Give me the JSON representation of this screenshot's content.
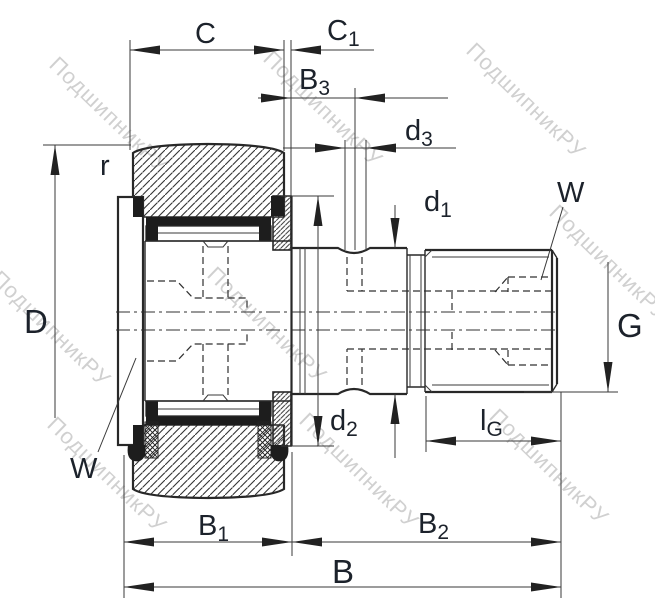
{
  "title": "Stud type track roller cam follower dimension drawing",
  "watermark": {
    "text": "ПодшипникРУ",
    "color": "#cbcbcb"
  },
  "colors": {
    "line": "#282828",
    "label": "#1c222b",
    "background": "#ffffff",
    "watermark": "#cbcbcb"
  },
  "dim_labels": {
    "C": "C",
    "C1": {
      "main": "C",
      "sub": "1"
    },
    "B3": {
      "main": "B",
      "sub": "3"
    },
    "d3": {
      "main": "d",
      "sub": "3"
    },
    "d1": {
      "main": "d",
      "sub": "1"
    },
    "d2": {
      "main": "d",
      "sub": "2"
    },
    "r": "r",
    "D": "D",
    "G": "G",
    "W_thread_end": "W",
    "W_flange_end": "W",
    "lG": {
      "main": "l",
      "sub": "G"
    },
    "B1": {
      "main": "B",
      "sub": "1"
    },
    "B2": {
      "main": "B",
      "sub": "2"
    },
    "B": "B"
  }
}
